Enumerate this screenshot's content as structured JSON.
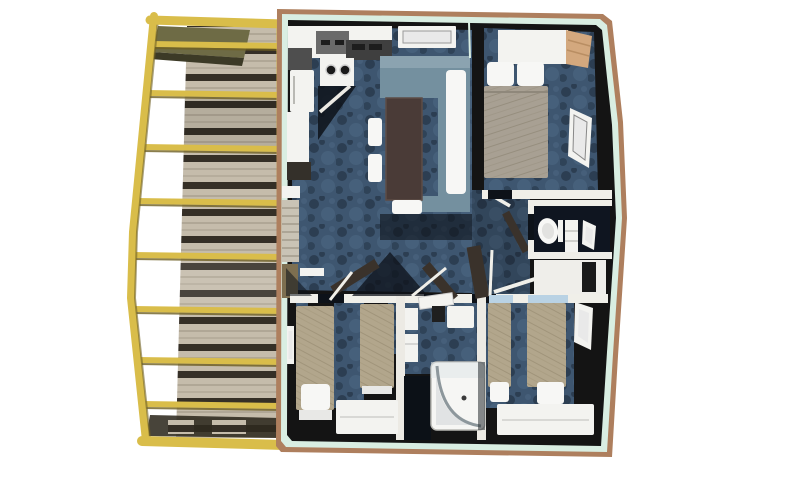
{
  "palette": {
    "bg": "#ffffff",
    "deckFrame": "#d9bd4a",
    "deckFrameShadow": "#6e5f23",
    "canopy": "#6e6b45",
    "canopyDark": "#3c3a26",
    "plank": "#c5bcab",
    "plankLine": "#b0a796",
    "plankGap": "#352f26",
    "deckDark": "#2f2a1f",
    "trim": "#ae7f5e",
    "lining": "#d9eee2",
    "wall": "#141414",
    "carpet": "#3e5670",
    "carpetDark": "#2c3e52",
    "carpetLight": "#4d6783",
    "couch": "#74909f",
    "couchTop": "#8ba3b0",
    "table": "#4a3b37",
    "white": "#f3f3f0",
    "pillow": "#f7f7f5",
    "duvet": "#a8a093",
    "duvetSpeck": "#968e7e",
    "blanket": "#b2a68c",
    "blanketSpeck": "#a0947a",
    "wood": "#d3a87e",
    "woodLine": "#b98e63",
    "glass": "#dfe5e8",
    "headboard": "#b9d2e4",
    "door": "#3a322b",
    "windowIn": "#e9e9e9",
    "counterDark": "#3f3f3f",
    "grey": "#6a6a6a",
    "shadow": "#0d1219",
    "bench": "#c9c3b5",
    "benchWood": "#7d6f50"
  },
  "scene": {
    "type": "3D top-down floor plan render of a mobile home with attached timber deck",
    "deck": {
      "frame": "yellow pergola frame",
      "floor": "horizontal timber planks",
      "bays": 8
    },
    "rooms": [
      {
        "name": "kitchen",
        "position": "top-left",
        "items": [
          "wall-cabinets",
          "range-hood",
          "stove-two-burners",
          "counter-with-sink",
          "fridge",
          "tall-cabinet"
        ]
      },
      {
        "name": "living-dining",
        "position": "top-center",
        "items": [
          "window",
          "corner-bench-sofa",
          "dining-table",
          "two-side-chairs",
          "end-chair",
          "white-bench-cushion"
        ]
      },
      {
        "name": "master-bedroom",
        "position": "top-right",
        "items": [
          "wardrobe",
          "double-bed",
          "two-pillows",
          "side-window",
          "door"
        ]
      },
      {
        "name": "wc",
        "position": "middle-right",
        "items": [
          "toilet",
          "storage-cabinet",
          "small-window"
        ]
      },
      {
        "name": "closet",
        "position": "below-wc",
        "items": [
          "open-white-door"
        ]
      },
      {
        "name": "hallway",
        "position": "center",
        "items": [
          "open-doors"
        ]
      },
      {
        "name": "twin-bedroom-left",
        "position": "bottom-left",
        "items": [
          "two-single-beds",
          "pillows",
          "dresser",
          "small-window"
        ]
      },
      {
        "name": "shower-room",
        "position": "bottom-center",
        "items": [
          "washbasin",
          "water-heater",
          "corner-shower-curved-glass",
          "door"
        ]
      },
      {
        "name": "twin-bedroom-right",
        "position": "bottom-right",
        "items": [
          "two-single-beds",
          "headboards",
          "pillows",
          "long-dresser",
          "side-window"
        ]
      }
    ]
  }
}
